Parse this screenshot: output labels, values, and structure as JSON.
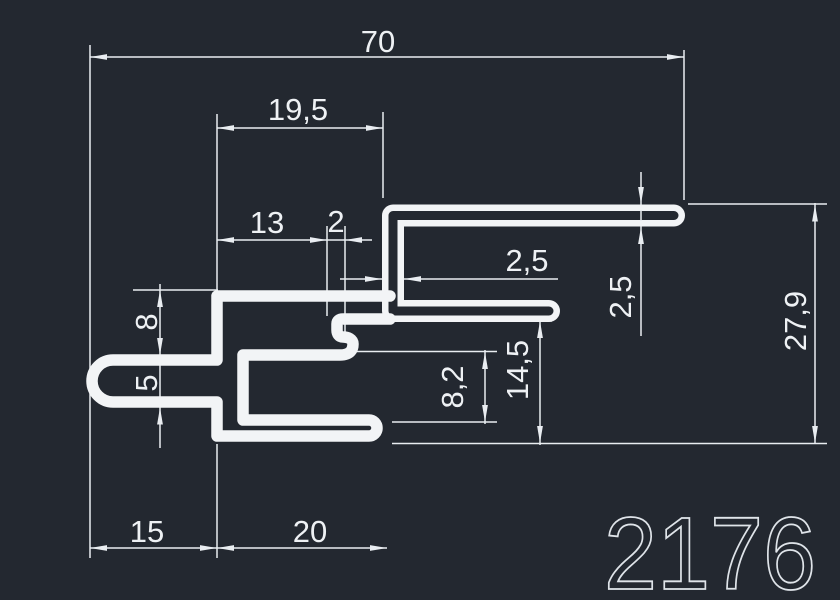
{
  "drawing": {
    "part_number": "2176",
    "colors": {
      "background": "#232830",
      "profile_line": "#f2f4f6",
      "dimension_line": "#e9edf1",
      "dimension_text": "#eef1f4",
      "part_number_text": "#dfe4e9"
    },
    "dims": {
      "total_width": "70",
      "top_arm_offset": "19,5",
      "hook_offset": "13",
      "hook_gap": "2",
      "wall_thickness": "2,5",
      "arm_thickness": "2,5",
      "total_height": "27,9",
      "step_height": "8",
      "slot_height": "5",
      "cavity_height": "8,2",
      "lower_height": "14,5",
      "left_arm_length": "15",
      "bottom_arm_length": "20"
    }
  }
}
